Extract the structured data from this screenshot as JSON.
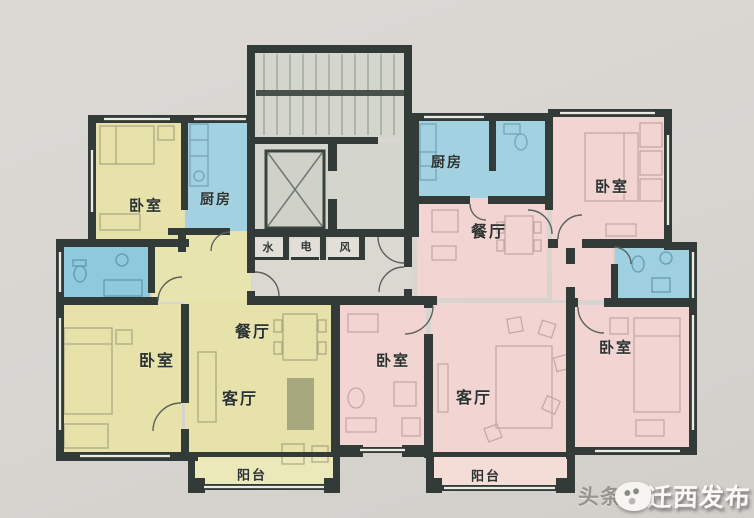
{
  "meta": {
    "type": "hand-drawn apartment floor plan photo, two residential units around a stair/elevator core"
  },
  "colors": {
    "background": "#d8d5d1",
    "wall": "#333b39",
    "left_unit_yellow": "#e6e2aa",
    "left_balcony_yellow": "#ebe8ba",
    "right_unit_pink": "#f2d5d2",
    "right_balcony_pink": "#f4dcd7",
    "wet_room_blue": "#a2d1e1",
    "bath_blue_deep": "#8fc9dd",
    "core_gray": "#d4d6cd",
    "lobby_gray": "#dbd8d1"
  },
  "core": {
    "utility_labels": [
      {
        "name": "water-shaft-label",
        "text": "水",
        "x": 268,
        "y": 247
      },
      {
        "name": "electric-shaft-label",
        "text": "电",
        "x": 306,
        "y": 246
      },
      {
        "name": "vent-shaft-label",
        "text": "风",
        "x": 345,
        "y": 247
      }
    ]
  },
  "units": [
    {
      "id": "left-unit",
      "rooms": [
        {
          "name": "bedroom-nw-label",
          "text": "卧室",
          "x": 146,
          "y": 205,
          "size": 15
        },
        {
          "name": "kitchen-left-label",
          "text": "厨房",
          "x": 216,
          "y": 199,
          "size": 14
        },
        {
          "name": "dining-left-label",
          "text": "餐厅",
          "x": 253,
          "y": 330,
          "size": 16
        },
        {
          "name": "bedroom-sw-label",
          "text": "卧室",
          "x": 157,
          "y": 359,
          "size": 16
        },
        {
          "name": "living-left-label",
          "text": "客厅",
          "x": 240,
          "y": 397,
          "size": 16
        },
        {
          "name": "balcony-left-label",
          "text": "阳台",
          "x": 252,
          "y": 474,
          "size": 13
        }
      ]
    },
    {
      "id": "right-unit",
      "rooms": [
        {
          "name": "kitchen-right-label",
          "text": "厨房",
          "x": 447,
          "y": 162,
          "size": 14
        },
        {
          "name": "bedroom-ne-label",
          "text": "卧室",
          "x": 612,
          "y": 186,
          "size": 15
        },
        {
          "name": "dining-right-label",
          "text": "餐厅",
          "x": 489,
          "y": 230,
          "size": 16
        },
        {
          "name": "bedroom-west-label",
          "text": "卧室",
          "x": 393,
          "y": 360,
          "size": 15
        },
        {
          "name": "living-right-label",
          "text": "客厅",
          "x": 474,
          "y": 396,
          "size": 16
        },
        {
          "name": "bedroom-east-label",
          "text": "卧室",
          "x": 616,
          "y": 347,
          "size": 15
        },
        {
          "name": "balcony-right-label",
          "text": "阳台",
          "x": 486,
          "y": 475,
          "size": 13
        }
      ]
    }
  ],
  "watermark": {
    "back_text": "头条",
    "front_text": "迁西发布"
  }
}
